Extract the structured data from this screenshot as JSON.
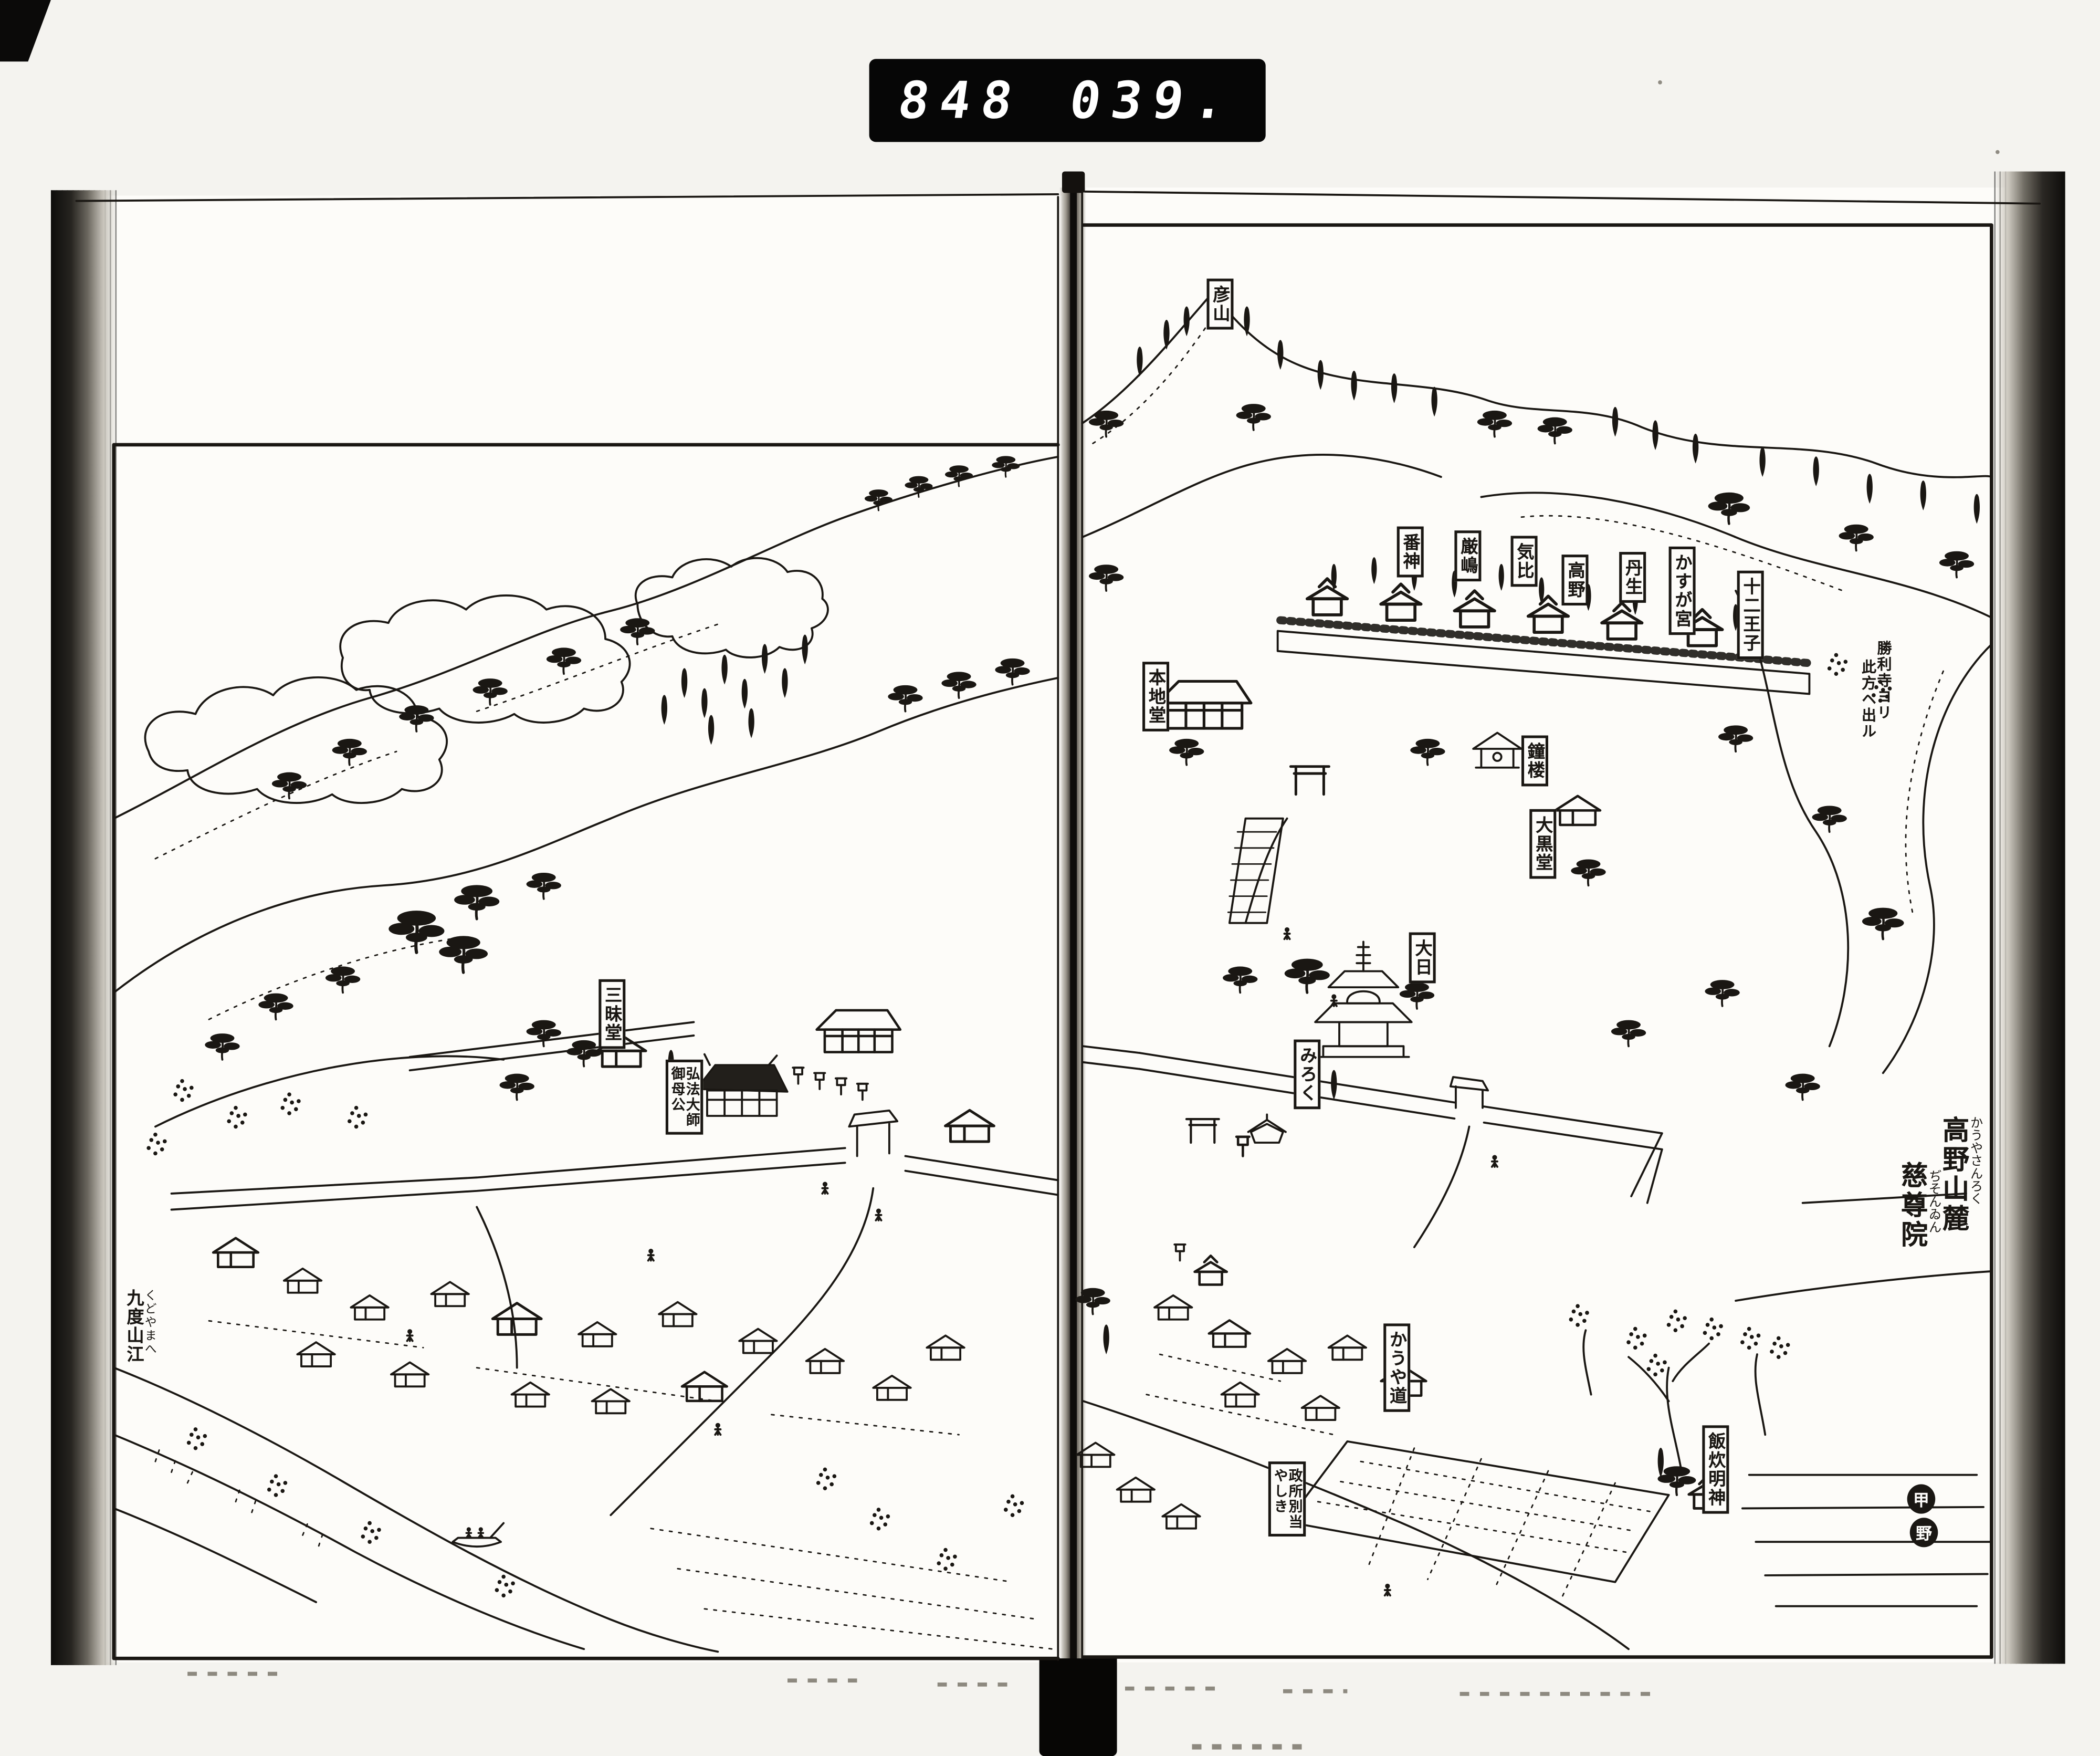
{
  "scan": {
    "counter_left": "848",
    "counter_right": "039.",
    "seal_top": "甲",
    "seal_bottom": "野"
  },
  "title": {
    "furigana1": "かうやさんろく",
    "main1": "高野山麓",
    "furigana2": "ぢそんゐん",
    "main2": "慈尊院"
  },
  "labels": {
    "peak": "彦山",
    "shrine1": "番神",
    "shrine2": "厳嶋",
    "shrine3": "気比",
    "shrine4": "高野",
    "shrine5": "丹生",
    "shrine6": "かすが宮",
    "shrine7": "十二王子",
    "route1": "勝利寺ヨリ",
    "route2": "此方ヘ出ル",
    "honjido": "本地堂",
    "shoro": "鐘楼",
    "daikokudo": "大黒堂",
    "dainichi": "大日",
    "sanmaido": "三昧堂",
    "daishi1": "弘法大師",
    "daishi2": "御母公",
    "miroku": "みろく",
    "mandokoro1": "政所別当",
    "mandokoro2": "やしき",
    "koyamichi": "かうや道",
    "meshitaki": "飯炊明神",
    "kudoyama_furigana": "くどやまへ",
    "kudoyama": "九度山江"
  },
  "colors": {
    "paper": "#fdfcf9",
    "scan_background": "#f4f3ef",
    "ink": "#1a1713",
    "counter_background": "#060606",
    "counter_digits": "#ffffff"
  }
}
